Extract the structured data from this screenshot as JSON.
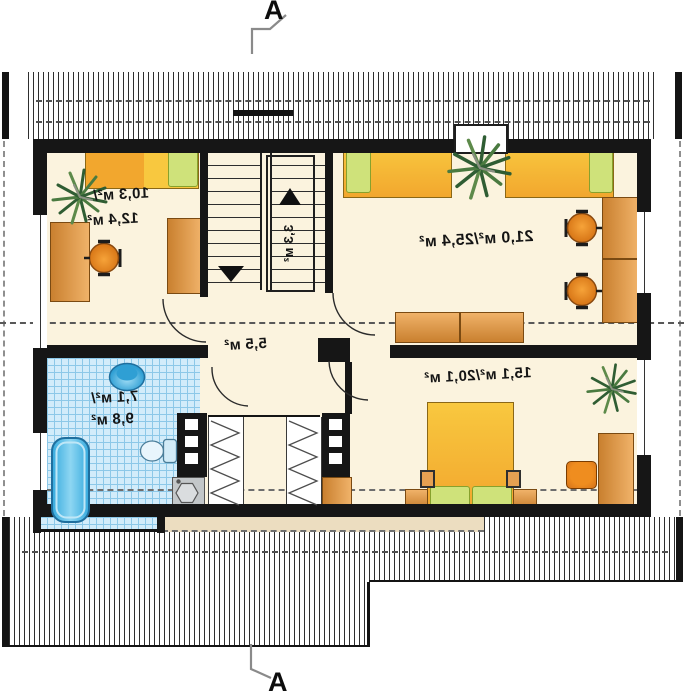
{
  "plan": {
    "section_top": "A",
    "section_bottom": "A",
    "rooms": {
      "bedroom_left": {
        "line1": "10,3 м²/",
        "line2": "12,4 м²"
      },
      "stairs": {
        "area": "3,3 м²"
      },
      "room_large": {
        "area": "21,0 м²/25,4 м²"
      },
      "hall": {
        "area": "5,5 м²"
      },
      "bathroom": {
        "line1": "7,1 м²/",
        "line2": "9,8 м²"
      },
      "bedroom_bottom": {
        "area": "15,1 м²/20,1 м²"
      }
    }
  },
  "colors": {
    "wall": "#161616",
    "floor": "#fbf3de",
    "tile": "#d2ecfa",
    "tileLine": "#8cc8e8",
    "bedYellow": "#f8c83f",
    "bedOrange": "#f2a72e",
    "pillow": "#cfe27a",
    "furn": "#e6a052",
    "chair": "#ef8d1f",
    "fixture": "#45b5e8",
    "plant": "#2f5d33",
    "washer": "#c3c7c9",
    "ledge": "#ecddc0"
  }
}
